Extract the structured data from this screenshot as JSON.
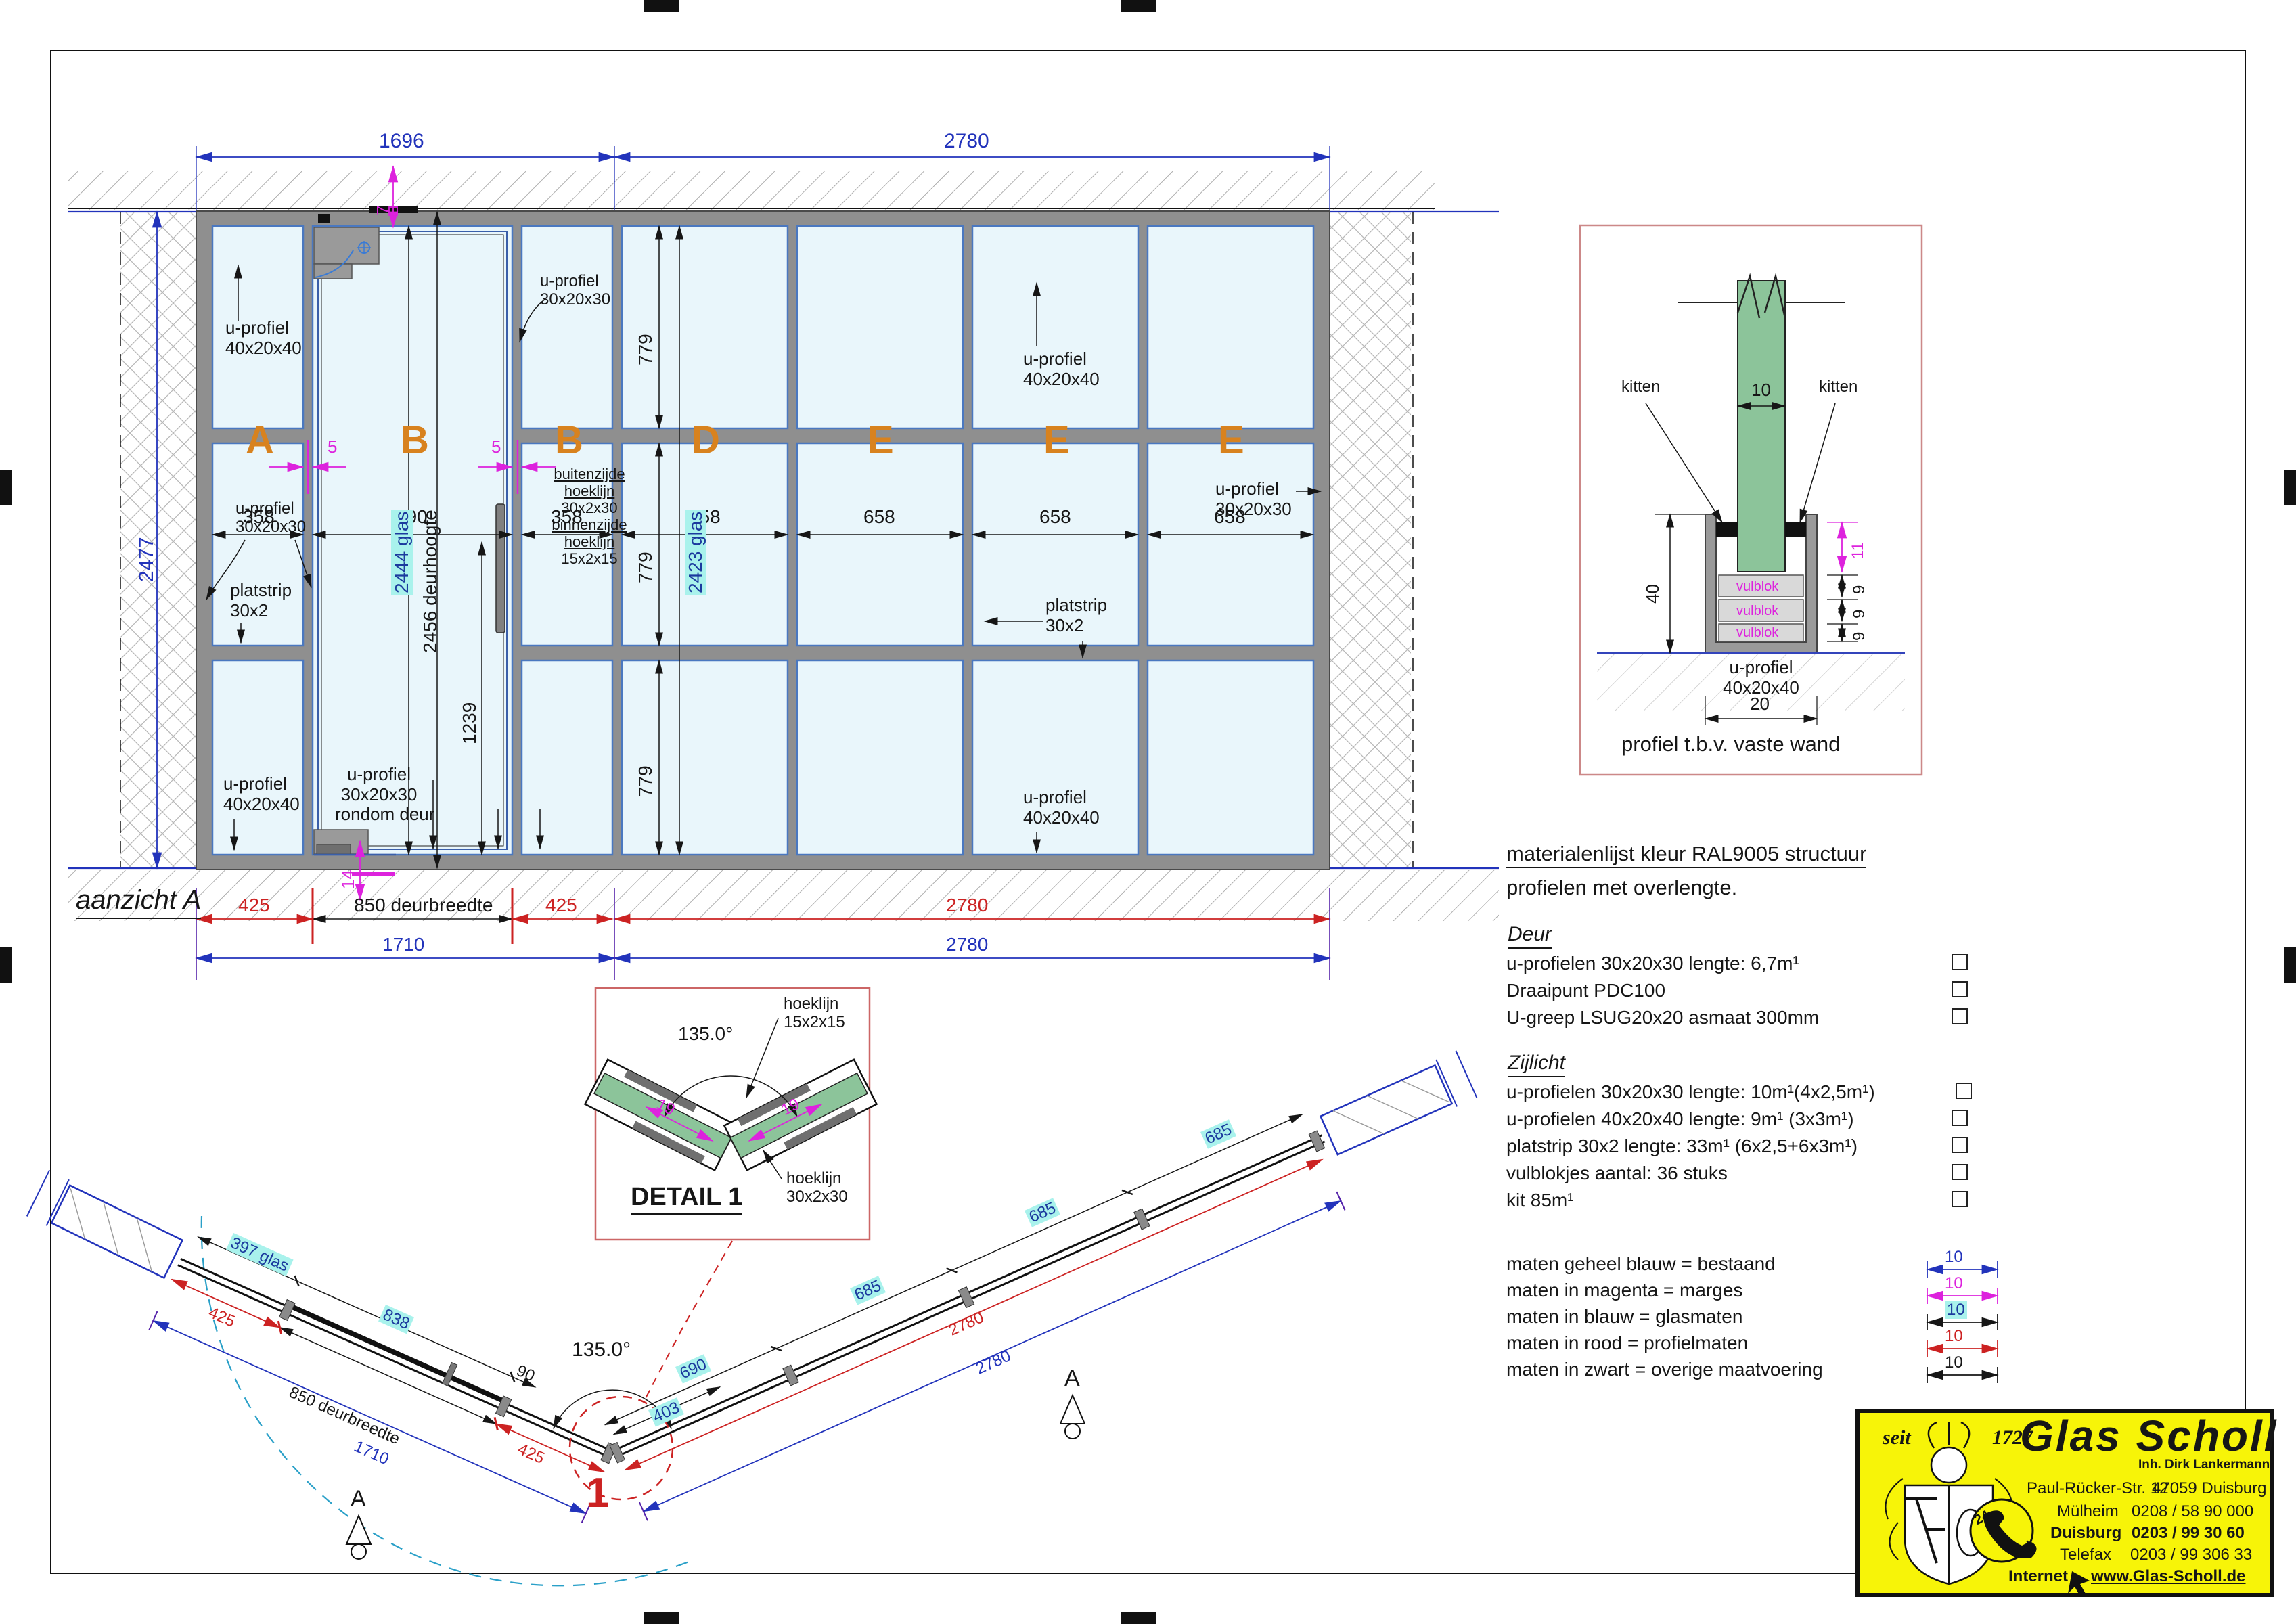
{
  "colors": {
    "existing_blue": "#2233bb",
    "margin_magenta": "#dd22dd",
    "glass_cyan_bg": "#a9f2ec",
    "profile_red": "#cc2222",
    "panel_orange": "#d8821e",
    "glass_fill": "#e9f6fb",
    "detail_glass_green": "#8cc49a",
    "logo_yellow": "#f7f408"
  },
  "elev": {
    "title": "aanzicht A",
    "dimTopL": "1696",
    "dimTopR": "2780",
    "dimLeft": "2477",
    "letters": [
      "A",
      "B",
      "B",
      "D",
      "E",
      "E",
      "E"
    ],
    "widths": [
      "358",
      "790",
      "358",
      "658",
      "658",
      "658",
      "658"
    ],
    "rows": [
      "779",
      "779",
      "779"
    ],
    "glassSide": "2423 glas",
    "glassDoor": "2444 glas",
    "doorH": "2456 deurhoogte",
    "h1239": "1239",
    "m7": "7",
    "m5a": "5",
    "m5b": "5",
    "m14": "14",
    "up4020": [
      "u-profiel",
      "40x20x40"
    ],
    "up3020": [
      "u-profiel",
      "30x20x30"
    ],
    "platstrip": [
      "platstrip",
      "30x2"
    ],
    "rondom": [
      "u-profiel",
      "30x20x30",
      "rondom deur"
    ],
    "hoek": [
      "buitenzijde",
      "hoeklijn",
      "30x2x30",
      "binnenzijde",
      "hoeklijn",
      "15x2x15"
    ],
    "b425l": "425",
    "b850": "850 deurbreedte",
    "b425r": "425",
    "b1710": "1710",
    "b2780r": "2780",
    "b2780b": "2780"
  },
  "det": {
    "kittenL": "kitten",
    "kittenR": "kitten",
    "g10": "10",
    "d40": "40",
    "m11": "11",
    "n9": [
      "9",
      "9",
      "9"
    ],
    "vul": [
      "vulblok",
      "vulblok",
      "vulblok"
    ],
    "prof": [
      "u-profiel",
      "40x20x40"
    ],
    "w20": "20",
    "title": "profiel t.b.v. vaste wand"
  },
  "mat": {
    "header": "materialenlijst kleur RAL9005 structuur",
    "sub": "profielen met overlengte.",
    "deurH": "Deur",
    "deur": [
      "u-profielen 30x20x30 lengte: 6,7m¹",
      "Draaipunt PDC100",
      "U-greep LSUG20x20 asmaat 300mm"
    ],
    "zijH": "Zijlicht",
    "zij": [
      "u-profielen 30x20x30 lengte: 10m¹(4x2,5m¹)",
      "u-profielen 40x20x40 lengte: 9m¹ (3x3m¹)",
      "platstrip 30x2 lengte: 33m¹ (6x2,5+6x3m¹)",
      "vulblokjes aantal: 36 stuks",
      "kit 85m¹"
    ]
  },
  "legend": {
    "labels": [
      "maten geheel blauw = bestaand",
      "maten in magenta = marges",
      "maten in blauw = glasmaten",
      "maten in rood = profielmaten",
      "maten in zwart = overige maatvoering"
    ],
    "values": [
      "10",
      "10",
      "10",
      "10",
      "10"
    ]
  },
  "plan": {
    "p397": "397 glas",
    "p838": "838",
    "p90": "90",
    "p425l": "425",
    "p850": "850 deurbreedte",
    "p1710": "1710",
    "p425r": "425",
    "p403": "403",
    "p690": "690",
    "p685": [
      "685",
      "685",
      "685"
    ],
    "p2780r": "2780",
    "p2780b": "2780",
    "angle": "135.0°",
    "marker1": "1",
    "viewA": "A"
  },
  "det1": {
    "title": "DETAIL 1",
    "angle": "135.0°",
    "hk15": [
      "hoeklijn",
      "15x2x15"
    ],
    "hk30": [
      "hoeklijn",
      "30x2x30"
    ],
    "d19": "19"
  },
  "logo": {
    "seit": "seit",
    "year": "1727",
    "name": "Glas Scholl",
    "inh": "Inh. Dirk Lankermann",
    "street": "Paul-Rücker-Str. 12",
    "city": "47059 Duisburg",
    "l2a": "Mülheim",
    "l2b": "0208 / 58 90 000",
    "l3a": "Duisburg",
    "l3b": "0203 / 99 30 60",
    "l4a": "Telefax",
    "l4b": "0203 / 99 306 33",
    "l5a": "Internet",
    "l5b": "www.Glas-Scholl.de",
    "p24": "24",
    "pstd": "Std"
  }
}
